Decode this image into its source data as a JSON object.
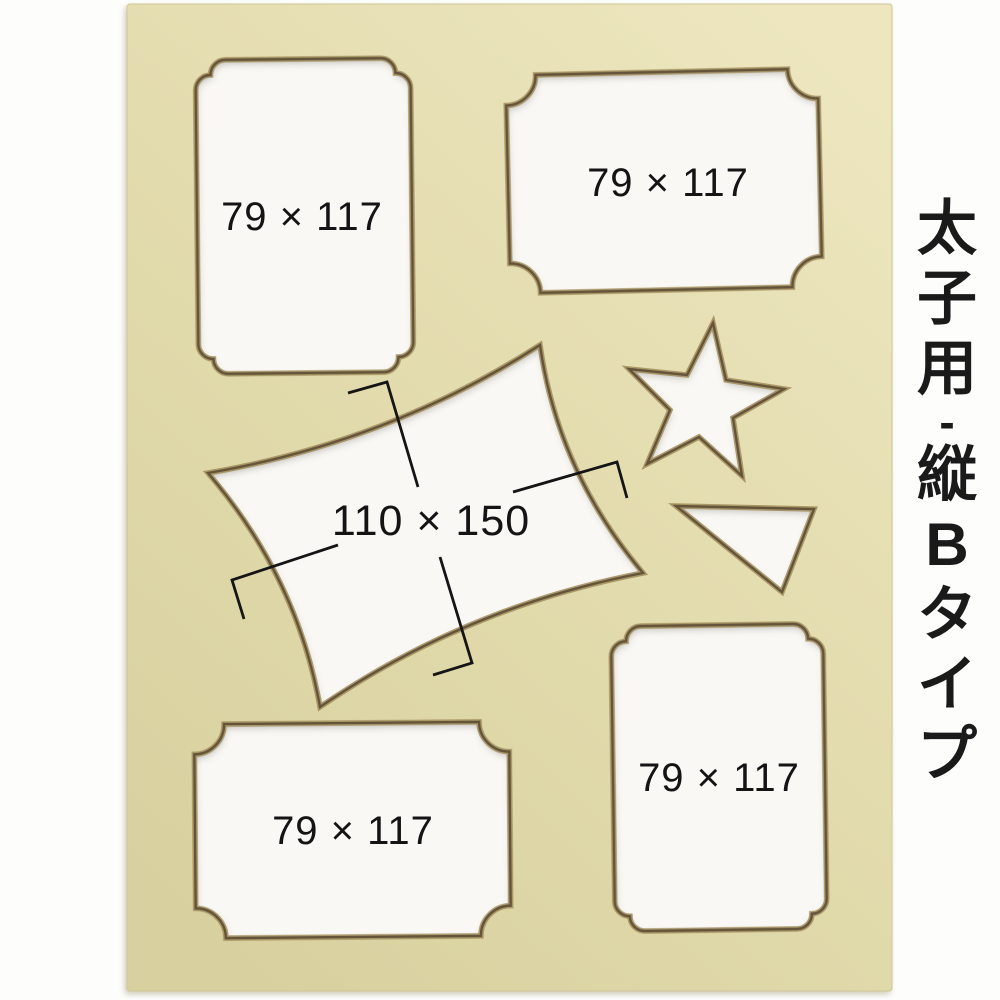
{
  "title_column": {
    "text": "太子用-縦Bタイプ",
    "chars": [
      "太",
      "子",
      "用",
      "-",
      "縦",
      "B",
      "タ",
      "イ",
      "プ"
    ]
  },
  "openings": {
    "top_left": {
      "label": "79 × 117",
      "shape": "vertical-rect-bracket-corners"
    },
    "top_right": {
      "label": "79 × 117",
      "shape": "horizontal-rect-concave-corners"
    },
    "center": {
      "label": "110 × 150",
      "shape": "concave-sided-rect-rotated"
    },
    "star": {
      "label": "",
      "shape": "five-point-star"
    },
    "triangle": {
      "label": "",
      "shape": "triangle"
    },
    "bottom_right": {
      "label": "79 × 117",
      "shape": "vertical-rect-bracket-corners"
    },
    "bottom_left": {
      "label": "79 × 117",
      "shape": "horizontal-rect-concave-corners"
    }
  },
  "colors": {
    "background": "#ffffff",
    "mat_board": "#e2dbad",
    "mat_board_light": "#ede6bf",
    "mat_board_dark": "#d8d09e",
    "bevel_dark": "#64543a",
    "bevel_light": "#a3905f",
    "cutout_fill": "#f9f8f4",
    "label_text": "#141414",
    "bracket_line": "#151515"
  }
}
